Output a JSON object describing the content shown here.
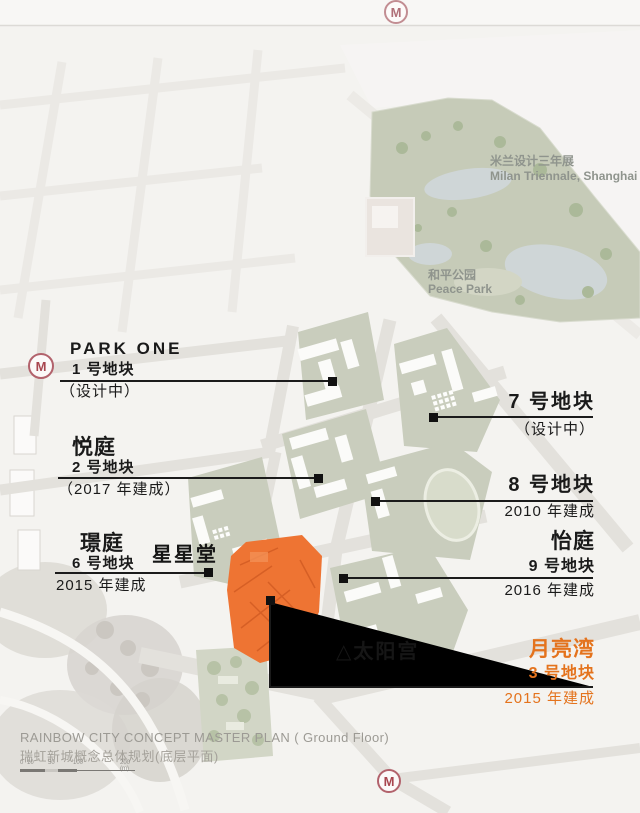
{
  "metro": {
    "letter": "M"
  },
  "park": {
    "triennale_zh": "米兰设计三年展",
    "triennale_en": "Milan Triennale, Shanghai",
    "name_zh": "和平公园",
    "name_en": "Peace Park"
  },
  "landmarks": {
    "star_hall": "星星堂",
    "sun_palace": "△太阳宫"
  },
  "plots": {
    "p1": {
      "name": "PARK ONE",
      "num": "1 号地块",
      "status": "（设计中）"
    },
    "p2": {
      "name": "悦庭",
      "num": "2 号地块",
      "status": "（2017 年建成）"
    },
    "p6": {
      "name": "璟庭",
      "num": "6 号地块",
      "status": "2015 年建成"
    },
    "p7": {
      "num": "7 号地块",
      "status": "（设计中）"
    },
    "p8": {
      "num": "8 号地块",
      "status": "2010 年建成"
    },
    "p9": {
      "name": "怡庭",
      "num": "9 号地块",
      "status": "2016 年建成"
    },
    "p3": {
      "name": "月亮湾",
      "num": "3 号地块",
      "status": "2015 年建成"
    }
  },
  "footer": {
    "title_en": "RAINBOW CITY CONCEPT MASTER PLAN ( Ground Floor)",
    "title_zh": "瑞虹新城概念总体规划(底层平面)",
    "scale_labels": [
      "0",
      "10",
      "50",
      "100",
      "200 (m)"
    ]
  },
  "colors": {
    "highlight_orange": "#ee7433",
    "highlight_text_orange": "#e4731d",
    "plot_green": "#c9cdbd",
    "park_green": "#c6cbb8",
    "metro_red": "#a8454f"
  }
}
